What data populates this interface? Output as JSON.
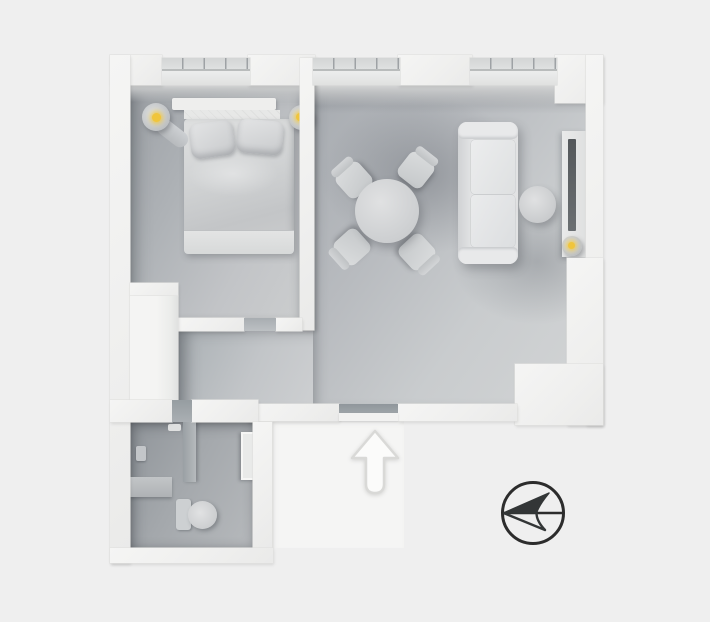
{
  "scene": {
    "type": "3d-floorplan-top-down-render",
    "background_color": "#efefef",
    "wall_color": "#f2f2f1",
    "floor_color_range": [
      "#90959a",
      "#d2d4d5"
    ],
    "lamp_glow_color": "#f0c53c"
  },
  "rooms": {
    "bedroom": {
      "label": "Bedroom",
      "windows": 1,
      "furniture": [
        "double bed",
        "headboard",
        "pillow left",
        "pillow right",
        "wall lamp left",
        "wall lamp right",
        "closet block"
      ]
    },
    "living_room": {
      "label": "Living / dining room",
      "windows": 2,
      "furniture": [
        "round dining table",
        "4 dining chairs",
        "sofa",
        "round side table",
        "tv console",
        "tv",
        "console lamp"
      ]
    },
    "hallway": {
      "label": "Hallway",
      "doors": [
        "bedroom door",
        "bathroom door",
        "entrance door"
      ]
    },
    "bathroom": {
      "label": "Bathroom",
      "furniture": [
        "shower",
        "shower partition",
        "bench ledge",
        "toilet",
        "mirror cabinet"
      ]
    }
  },
  "indicators": {
    "entrance_arrow": {
      "label": "Entrance direction arrow",
      "direction": "up",
      "fill": "#fbfbfa",
      "stroke": "#d9d9d7"
    },
    "compass": {
      "label": "Compass / north indicator",
      "pointing": "left",
      "stroke": "#2c2c2c",
      "fill": "#333637"
    }
  }
}
